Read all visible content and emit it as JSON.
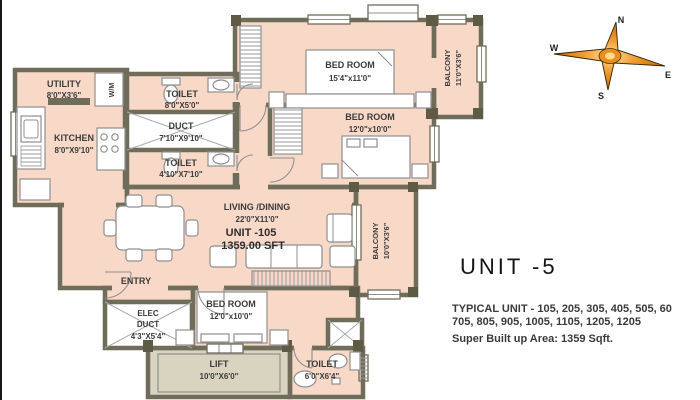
{
  "plan": {
    "rooms": {
      "utility": {
        "name": "UTILITY",
        "size": "8'0\"X3'6\""
      },
      "wm": {
        "label": "W/M"
      },
      "kitchen": {
        "name": "KITCHEN",
        "size": "8'0\"X9'10\""
      },
      "toilet_top": {
        "name": "TOILET",
        "size": "8'0\"X5'0\""
      },
      "duct": {
        "name": "DUCT",
        "size": "7'10\"X9'10\""
      },
      "toilet_mid": {
        "name": "TOILET",
        "size": "4'10\"X7'10\""
      },
      "bedroom_master": {
        "name": "BED ROOM",
        "size": "15'4\"x11'0\""
      },
      "balcony_top": {
        "name": "BALCONY",
        "size": "11'0\"X3'6\""
      },
      "bedroom_mid": {
        "name": "BED ROOM",
        "size": "12'0\"x10'0\""
      },
      "balcony_mid": {
        "name": "BALCONY",
        "size": "10'0\"X3'6\""
      },
      "living": {
        "name": "LIVING /DINING",
        "size": "22'0\"X11'0\"",
        "unit": "UNIT -105",
        "area": "1359.00 SFT"
      },
      "entry": {
        "name": "ENTRY"
      },
      "elec_duct": {
        "line1": "ELEC",
        "line2": "DUCT",
        "size": "4'3\"X5'4\""
      },
      "bedroom_bottom": {
        "name": "BED ROOM",
        "size": "12'0\"x10'0\""
      },
      "lift": {
        "name": "LIFT",
        "size": "10'0\"X6'0\""
      },
      "toilet_bottom": {
        "name": "TOILET",
        "size": "6'0\"X6'4\""
      }
    },
    "colors": {
      "floor": "#f8d9c8",
      "wall": "#6f6d59",
      "lift_floor": "#d9d4c0",
      "compass_orange": "#d97d12"
    }
  },
  "compass": {
    "n": "N",
    "e": "E",
    "s": "S",
    "w": "W"
  },
  "annotation": {
    "unit_title": "UNIT -5",
    "typical_line1": "TYPICAL UNIT - 105, 205, 305, 405, 505, 60",
    "typical_line2": "705, 805, 905, 1005, 1105, 1205, 1205",
    "super_area": "Super Built up Area: 1359 Sqft."
  }
}
